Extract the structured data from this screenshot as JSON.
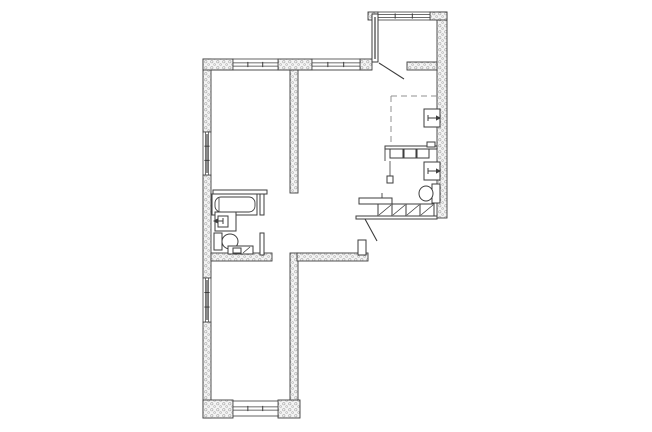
{
  "meta": {
    "kind": "architectural-floor-plan",
    "canvas": {
      "width": 652,
      "height": 432
    }
  },
  "colors": {
    "background": "#ffffff",
    "line": "#3d3d3d",
    "wall_fill": "#f4f4f4",
    "wall_dot": "#a8a8a8",
    "glass": "#8a8a8a",
    "dash": "#909090",
    "white": "#ffffff"
  },
  "plan": {
    "elements": [
      {
        "n": "left-wall-upper",
        "t": "wall",
        "r": [
          203,
          59,
          8,
          73
        ]
      },
      {
        "n": "left-wall-middle",
        "t": "wall",
        "r": [
          203,
          175,
          8,
          103
        ]
      },
      {
        "n": "left-wall-lower",
        "t": "wall",
        "r": [
          203,
          322,
          8,
          96
        ]
      },
      {
        "n": "top-wall-segment-a",
        "t": "wall",
        "r": [
          203,
          59,
          30,
          11
        ]
      },
      {
        "n": "top-wall-segment-b",
        "t": "wall",
        "r": [
          278,
          59,
          34,
          11
        ]
      },
      {
        "n": "top-wall-segment-c",
        "t": "wall",
        "r": [
          360,
          59,
          12,
          11
        ]
      },
      {
        "n": "bottom-wall-left",
        "t": "wall",
        "r": [
          203,
          400,
          30,
          18
        ]
      },
      {
        "n": "bottom-wall-right",
        "t": "wall",
        "r": [
          278,
          400,
          22,
          18
        ]
      },
      {
        "n": "right-wall",
        "t": "wall",
        "r": [
          437,
          12,
          10,
          206
        ]
      },
      {
        "n": "balcony-corner-left",
        "t": "wall",
        "r": [
          368,
          12,
          10,
          8
        ]
      },
      {
        "n": "balcony-corner-right",
        "t": "wall",
        "r": [
          430,
          12,
          17,
          8
        ]
      },
      {
        "n": "balcony-bottom-wall",
        "t": "wall",
        "r": [
          407,
          62,
          30,
          8
        ]
      },
      {
        "n": "interior-wall-upper",
        "t": "wall",
        "r": [
          290,
          70,
          8,
          123
        ]
      },
      {
        "n": "interior-wall-lower",
        "t": "wall",
        "r": [
          290,
          253,
          8,
          147
        ]
      },
      {
        "n": "hall-wall",
        "t": "wall",
        "r": [
          297,
          253,
          71,
          8
        ]
      },
      {
        "n": "bathroom-outer-wall",
        "t": "wall",
        "r": [
          211,
          253,
          61,
          8
        ]
      },
      {
        "n": "top-window-left",
        "t": "winh",
        "r": [
          233,
          59,
          45,
          11
        ]
      },
      {
        "n": "top-window-right",
        "t": "winh",
        "r": [
          312,
          59,
          48,
          11
        ]
      },
      {
        "n": "bottom-window",
        "t": "winh",
        "r": [
          233,
          401,
          45,
          15
        ]
      },
      {
        "n": "balcony-window",
        "t": "winh",
        "r": [
          378,
          12,
          52,
          8
        ]
      },
      {
        "n": "left-window-upper",
        "t": "winv",
        "r": [
          203,
          132,
          8,
          43
        ]
      },
      {
        "n": "left-window-lower",
        "t": "winv",
        "r": [
          203,
          278,
          8,
          44
        ]
      },
      {
        "n": "bathroom-wall-top",
        "t": "box",
        "r": [
          213,
          190,
          54,
          4
        ]
      },
      {
        "n": "bathroom-wall-right-upper",
        "t": "box",
        "r": [
          260,
          194,
          4,
          21
        ]
      },
      {
        "n": "bathroom-wall-right-lower",
        "t": "box",
        "r": [
          260,
          233,
          4,
          22
        ]
      },
      {
        "n": "balcony-glass-partition",
        "t": "box",
        "r": [
          372,
          14,
          6,
          48
        ]
      },
      {
        "n": "balcony-glass-bar",
        "t": "bar",
        "r": [
          374,
          17,
          2,
          42
        ],
        "c": "glass"
      },
      {
        "n": "entry-wall-stub",
        "t": "box",
        "r": [
          358,
          240,
          8,
          15
        ]
      },
      {
        "n": "bathtub",
        "t": "box",
        "r": [
          212,
          194,
          45,
          21
        ]
      },
      {
        "n": "bathtub-inner",
        "t": "rrect",
        "r": [
          215,
          197,
          40,
          15
        ],
        "rx": 6
      },
      {
        "n": "bathtub-drain-line",
        "t": "line",
        "p": [
          219,
          198,
          219,
          211
        ],
        "w": 0.8
      },
      {
        "n": "bathroom-sink",
        "t": "box",
        "r": [
          215,
          212,
          21,
          19
        ]
      },
      {
        "n": "bathroom-sink-basin",
        "t": "box",
        "r": [
          218,
          216,
          10,
          11
        ]
      },
      {
        "n": "bathroom-sink-faucet",
        "t": "arrow",
        "p": [
          223,
          221,
          213,
          221
        ]
      },
      {
        "n": "toilet-tank",
        "t": "box",
        "r": [
          214,
          233,
          8,
          17
        ]
      },
      {
        "n": "toilet-bowl",
        "t": "ellipse",
        "e": [
          230,
          241.5,
          8,
          7.5
        ]
      },
      {
        "n": "washer-box",
        "t": "box",
        "r": [
          228,
          246,
          25,
          8
        ]
      },
      {
        "n": "washer-inner",
        "t": "box",
        "r": [
          233,
          248,
          8,
          5
        ]
      },
      {
        "n": "washer-diagonal",
        "t": "line",
        "p": [
          243,
          253,
          250,
          247
        ],
        "w": 0.8
      },
      {
        "n": "kitchen-counter-edge",
        "t": "box",
        "r": [
          385,
          146,
          52,
          3
        ]
      },
      {
        "n": "kitchen-counter-box-1",
        "t": "box",
        "r": [
          390,
          149,
          13,
          9
        ]
      },
      {
        "n": "kitchen-counter-box-2",
        "t": "box",
        "r": [
          404,
          149,
          12,
          9
        ]
      },
      {
        "n": "kitchen-counter-box-3",
        "t": "box",
        "r": [
          417,
          149,
          12,
          9
        ]
      },
      {
        "n": "kitchen-counter-end-box",
        "t": "box",
        "r": [
          427,
          142,
          8,
          5
        ]
      },
      {
        "n": "kitchen-counter-left-line",
        "t": "line",
        "p": [
          385,
          149,
          385,
          161
        ],
        "w": 0.9
      },
      {
        "n": "kitchen-side-line",
        "t": "line",
        "p": [
          390,
          161,
          390,
          176
        ],
        "w": 0.8
      },
      {
        "n": "kitchen-side-box",
        "t": "box",
        "r": [
          387,
          176,
          6,
          7
        ]
      },
      {
        "n": "wall-fixture-upper",
        "t": "box",
        "r": [
          424,
          109,
          16,
          18
        ]
      },
      {
        "n": "wall-fixture-upper-arrow",
        "t": "arrow",
        "p": [
          428,
          118,
          441,
          118
        ]
      },
      {
        "n": "wall-fixture-lower",
        "t": "box",
        "r": [
          424,
          162,
          16,
          18
        ]
      },
      {
        "n": "wall-fixture-lower-arrow",
        "t": "arrow",
        "p": [
          428,
          171,
          441,
          171
        ]
      },
      {
        "n": "toilet2-tank",
        "t": "box",
        "r": [
          432,
          184,
          8,
          19
        ]
      },
      {
        "n": "toilet2-bowl",
        "t": "ellipse",
        "e": [
          426,
          193.5,
          7,
          7.5
        ]
      },
      {
        "n": "dashed-area-top",
        "t": "dline",
        "p": [
          391,
          96,
          437,
          96
        ]
      },
      {
        "n": "dashed-area-left",
        "t": "dline",
        "p": [
          391,
          96,
          391,
          147
        ]
      },
      {
        "n": "entry-top-strip",
        "t": "box",
        "r": [
          359,
          198,
          33,
          6
        ]
      },
      {
        "n": "entry-jamb-tick",
        "t": "line",
        "p": [
          382,
          193,
          382,
          198
        ],
        "w": 0.9
      },
      {
        "n": "entry-cabinet-1",
        "t": "box",
        "r": [
          378,
          204,
          14,
          12
        ]
      },
      {
        "n": "entry-cabinet-1-diag",
        "t": "line",
        "p": [
          379,
          215,
          391,
          205
        ],
        "w": 0.8
      },
      {
        "n": "entry-cabinet-2",
        "t": "box",
        "r": [
          392,
          204,
          14,
          12
        ]
      },
      {
        "n": "entry-cabinet-2-diag",
        "t": "line",
        "p": [
          393,
          215,
          405,
          205
        ],
        "w": 0.8
      },
      {
        "n": "entry-cabinet-3",
        "t": "box",
        "r": [
          406,
          204,
          14,
          12
        ]
      },
      {
        "n": "entry-cabinet-3-diag",
        "t": "line",
        "p": [
          407,
          215,
          419,
          205
        ],
        "w": 0.8
      },
      {
        "n": "entry-cabinet-4",
        "t": "box",
        "r": [
          420,
          204,
          14,
          12
        ]
      },
      {
        "n": "entry-cabinet-4-diag",
        "t": "line",
        "p": [
          421,
          215,
          433,
          205
        ],
        "w": 0.8
      },
      {
        "n": "entry-bottom-band",
        "t": "box",
        "r": [
          356,
          216,
          81,
          3
        ]
      },
      {
        "n": "entry-door-leaf",
        "t": "line",
        "p": [
          365,
          219,
          377,
          241
        ],
        "w": 1.1
      },
      {
        "n": "balcony-door-leaf",
        "t": "line",
        "p": [
          379,
          63,
          404,
          79
        ],
        "w": 1.1
      },
      {
        "n": "top-wall-inner-face",
        "t": "line",
        "p": [
          211,
          70,
          372,
          70
        ],
        "w": 0.6
      }
    ]
  }
}
